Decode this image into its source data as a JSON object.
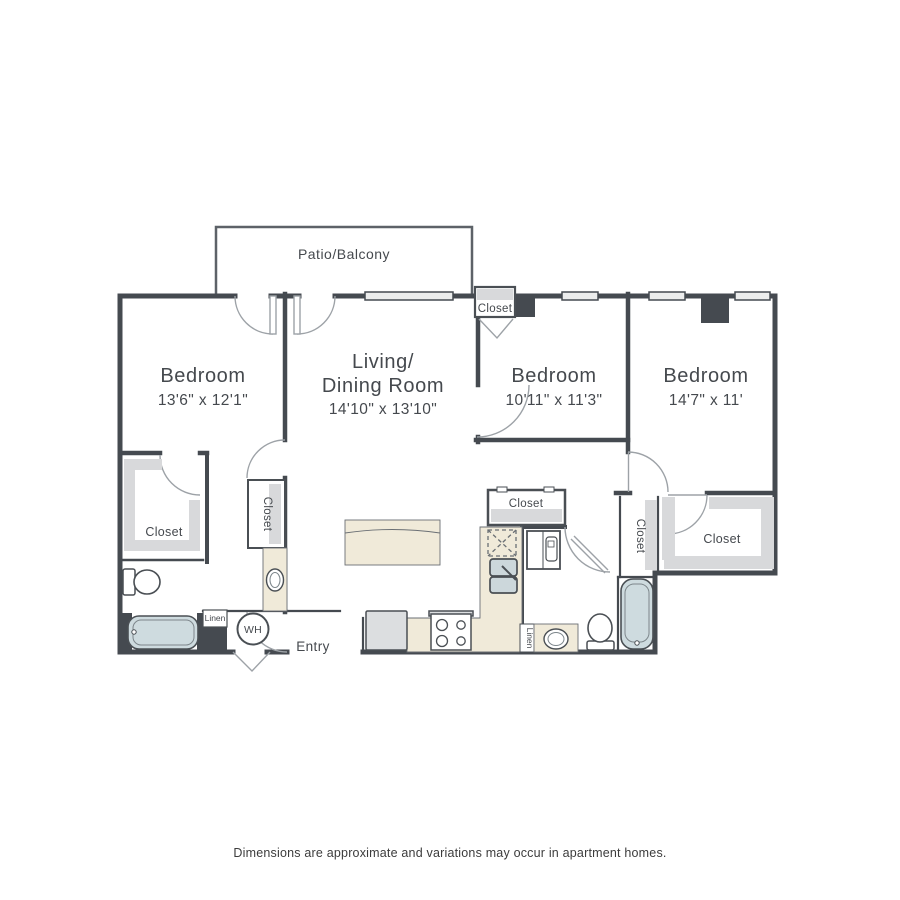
{
  "disclaimer": "Dimensions are approximate and variations may occur in apartment homes.",
  "rooms": {
    "patio": {
      "name": "Patio/Balcony"
    },
    "bedroom1": {
      "name": "Bedroom",
      "dims": "13'6\" x 12'1\""
    },
    "living": {
      "line1": "Living/",
      "line2": "Dining Room",
      "dims": "14'10\" x 13'10\""
    },
    "bedroom2": {
      "name": "Bedroom",
      "dims": "10'11\" x 11'3\""
    },
    "bedroom3": {
      "name": "Bedroom",
      "dims": "14'7\" x 11'"
    }
  },
  "labels": {
    "closet": "Closet",
    "linen": "Linen",
    "water_heater": "WH",
    "entry": "Entry"
  },
  "colors": {
    "wall": "#454a50",
    "door_arc": "#9da2a7",
    "closet_band": "#d8d9db",
    "counter_beige": "#f0ead9",
    "tub_blue": "#cedbdf",
    "window_fill": "#eceded",
    "text": "#45494e",
    "background": "#ffffff"
  }
}
